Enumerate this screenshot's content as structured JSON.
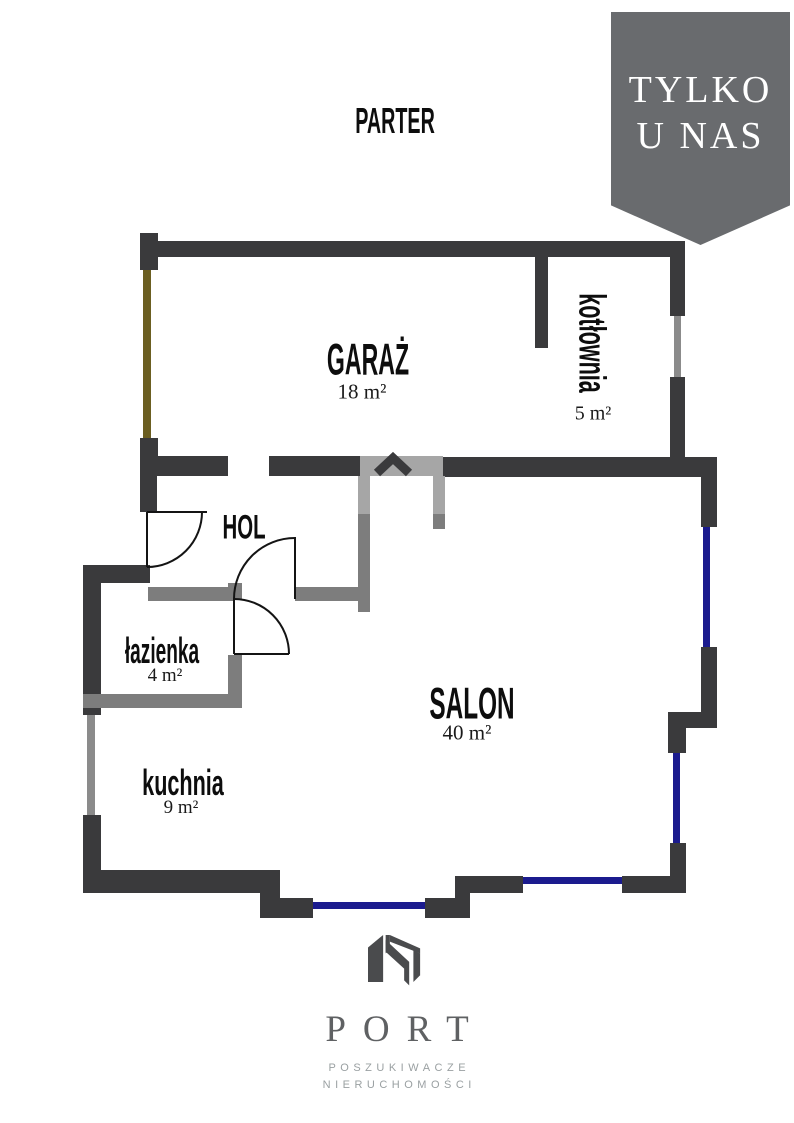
{
  "title": {
    "label": "PARTER"
  },
  "ribbon": {
    "line1": "TYLKO",
    "line2": "U NAS"
  },
  "rooms": [
    {
      "name": "GARAŻ",
      "area": "18 m²"
    },
    {
      "name": "kotłownia",
      "area": "5 m²"
    },
    {
      "name": "HOL"
    },
    {
      "name": "łazienka",
      "area": "4 m²"
    },
    {
      "name": "SALON",
      "area": "40 m²"
    },
    {
      "name": "kuchnia",
      "area": "9 m²"
    }
  ],
  "logo": {
    "brand": "PORT",
    "tagline_line1": "POSZUKIWACZE",
    "tagline_line2": "NIERUCHOMOŚCI"
  },
  "colors": {
    "wall_dark": "#3a3a3c",
    "wall_gray": "#7d7d7d",
    "wall_light": "#a6a6a6",
    "window_blue": "#1b1b8e",
    "window_gray": "#8b8b8b",
    "garage_door": "#6b5e21",
    "ribbon": "#696b6e",
    "logo_mark": "#4a4b4d",
    "logo_text": "#5f6163",
    "logo_sub": "#9aa0a2"
  }
}
